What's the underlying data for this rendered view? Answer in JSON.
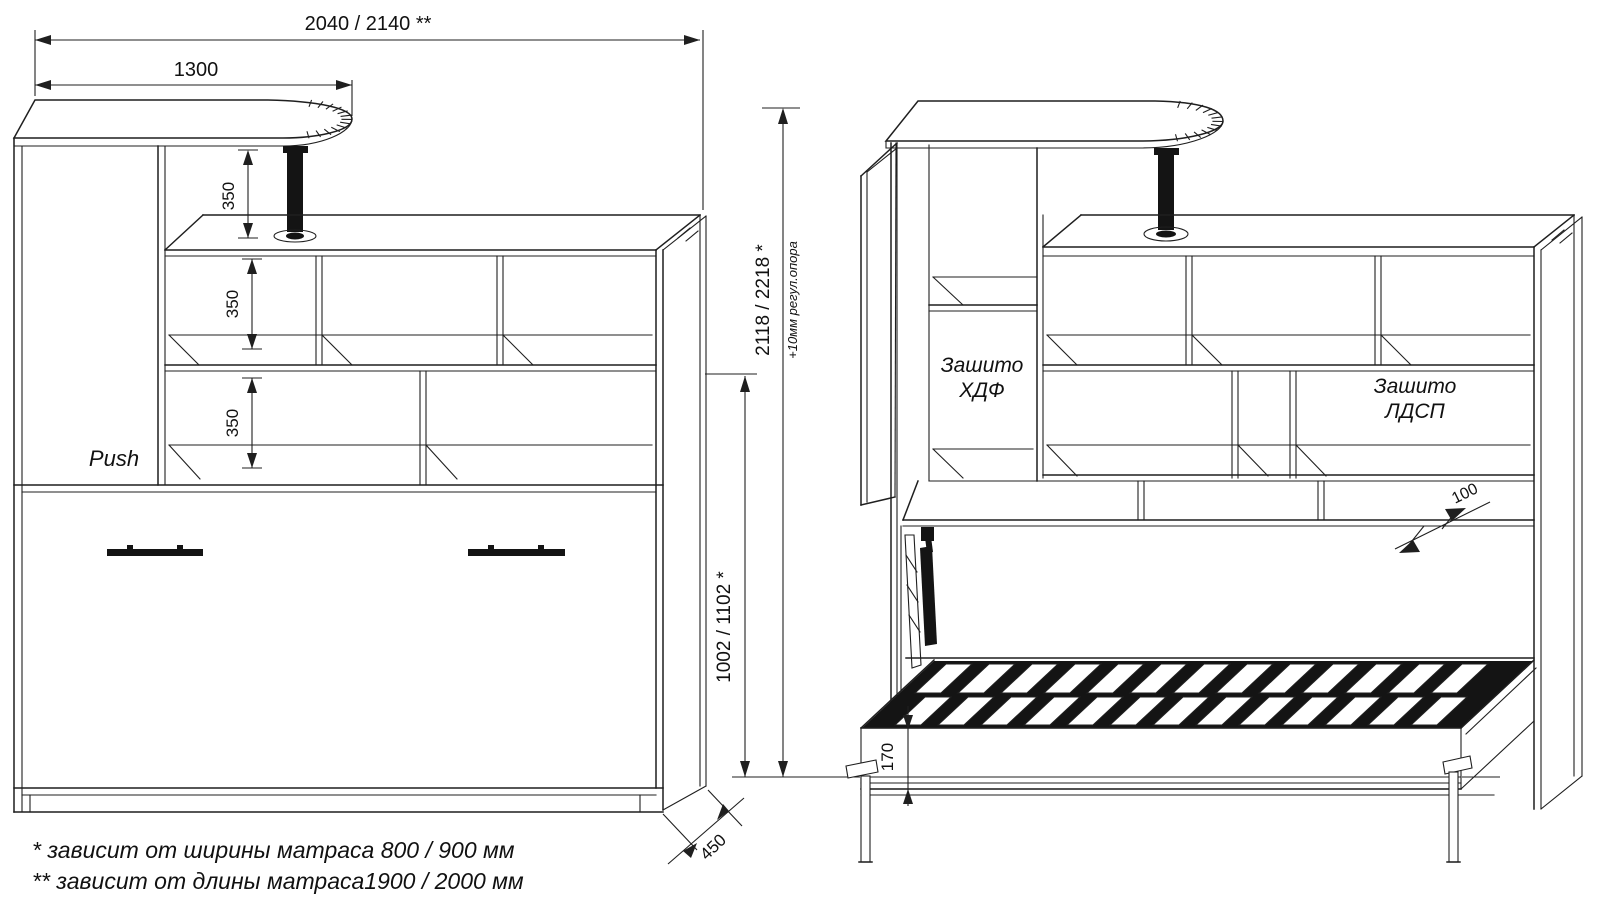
{
  "colors": {
    "line": "#1f1f1f",
    "dark_fill": "#141414",
    "background": "#ffffff"
  },
  "dims": {
    "top_width": "2040 / 2140 **",
    "desk_width": "1300",
    "shelf_gap_1": "350",
    "shelf_gap_2": "350",
    "shelf_gap_3": "350",
    "total_height": "2118 / 2218 *",
    "height_note": "+10мм регул.опора",
    "bed_section_height": "1002 / 1102 *",
    "cabinet_depth": "450",
    "shelf_offset": "100",
    "frame_height": "170"
  },
  "labels": {
    "push": "Push",
    "hdf_line1": "Зашито",
    "hdf_line2": "ХДФ",
    "ldsp_line1": "Зашито",
    "ldsp_line2": "ЛДСП"
  },
  "footnotes": [
    "*  зависит от ширины матраса 800 / 900 мм",
    "** зависит от длины матраса1900 / 2000 мм"
  ]
}
